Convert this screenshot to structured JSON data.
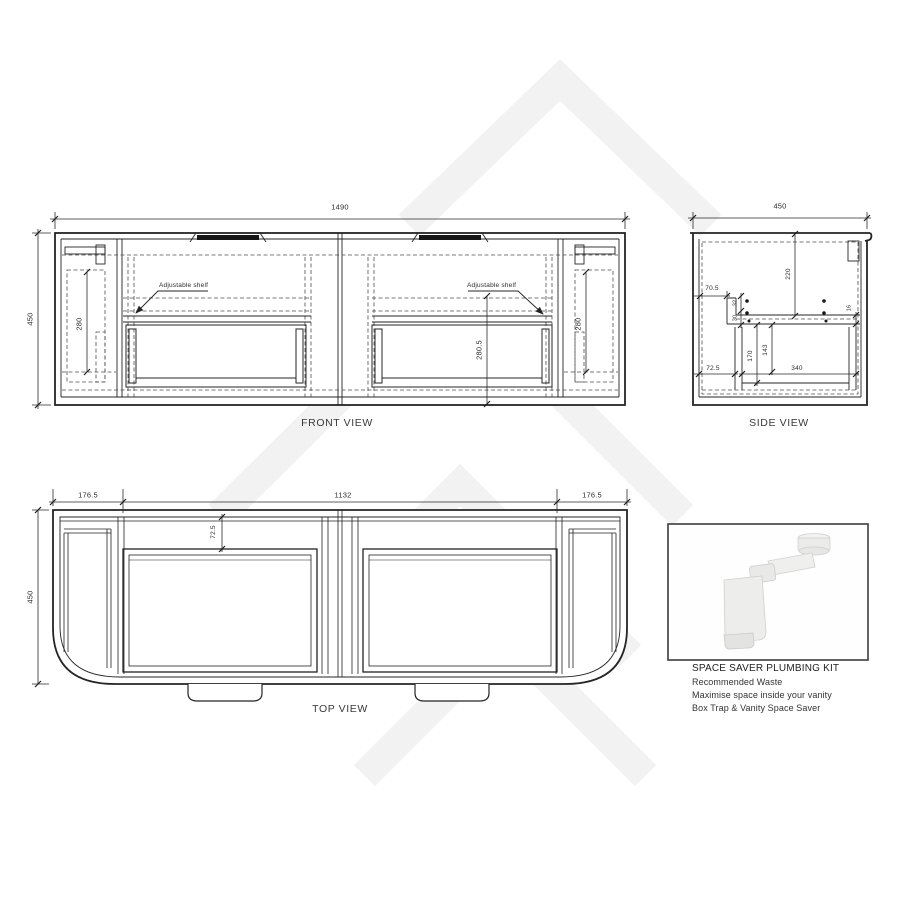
{
  "front_view": {
    "title": "FRONT VIEW",
    "dim_width": "1490",
    "dim_height": "450",
    "dim_left_door": "280",
    "dim_right_door": "280",
    "dim_opening": "280.5",
    "note_left": "Adjustable shelf",
    "note_right": "Adjustable shelf"
  },
  "side_view": {
    "title": "SIDE VIEW",
    "dim_depth": "450",
    "dim_top_clearance": "220",
    "dim_front_setback": "70.5",
    "dim_rail_gap": "32",
    "dim_shelf_thickness": "30",
    "dim_back_rail": "16",
    "dim_drawer_depth": "170",
    "dim_drawer_inner": "143",
    "dim_drawer_width": "340",
    "dim_bottom_setback": "72.5"
  },
  "top_view": {
    "title": "TOP VIEW",
    "dim_left": "176.5",
    "dim_center": "1132",
    "dim_right": "176.5",
    "dim_depth": "450",
    "dim_inset": "72.5"
  },
  "plumbing_kit": {
    "title": "SPACE SAVER PLUMBING KIT",
    "line1": "Recommended Waste",
    "line2": "Maximise space inside your vanity",
    "line3": "Box Trap & Vanity Space Saver"
  },
  "colors": {
    "line": "#242424",
    "hidden_line": "#4d4d4d",
    "dimension": "#2b2b2b",
    "watermark": "#f2f2f2",
    "background": "#ffffff"
  }
}
